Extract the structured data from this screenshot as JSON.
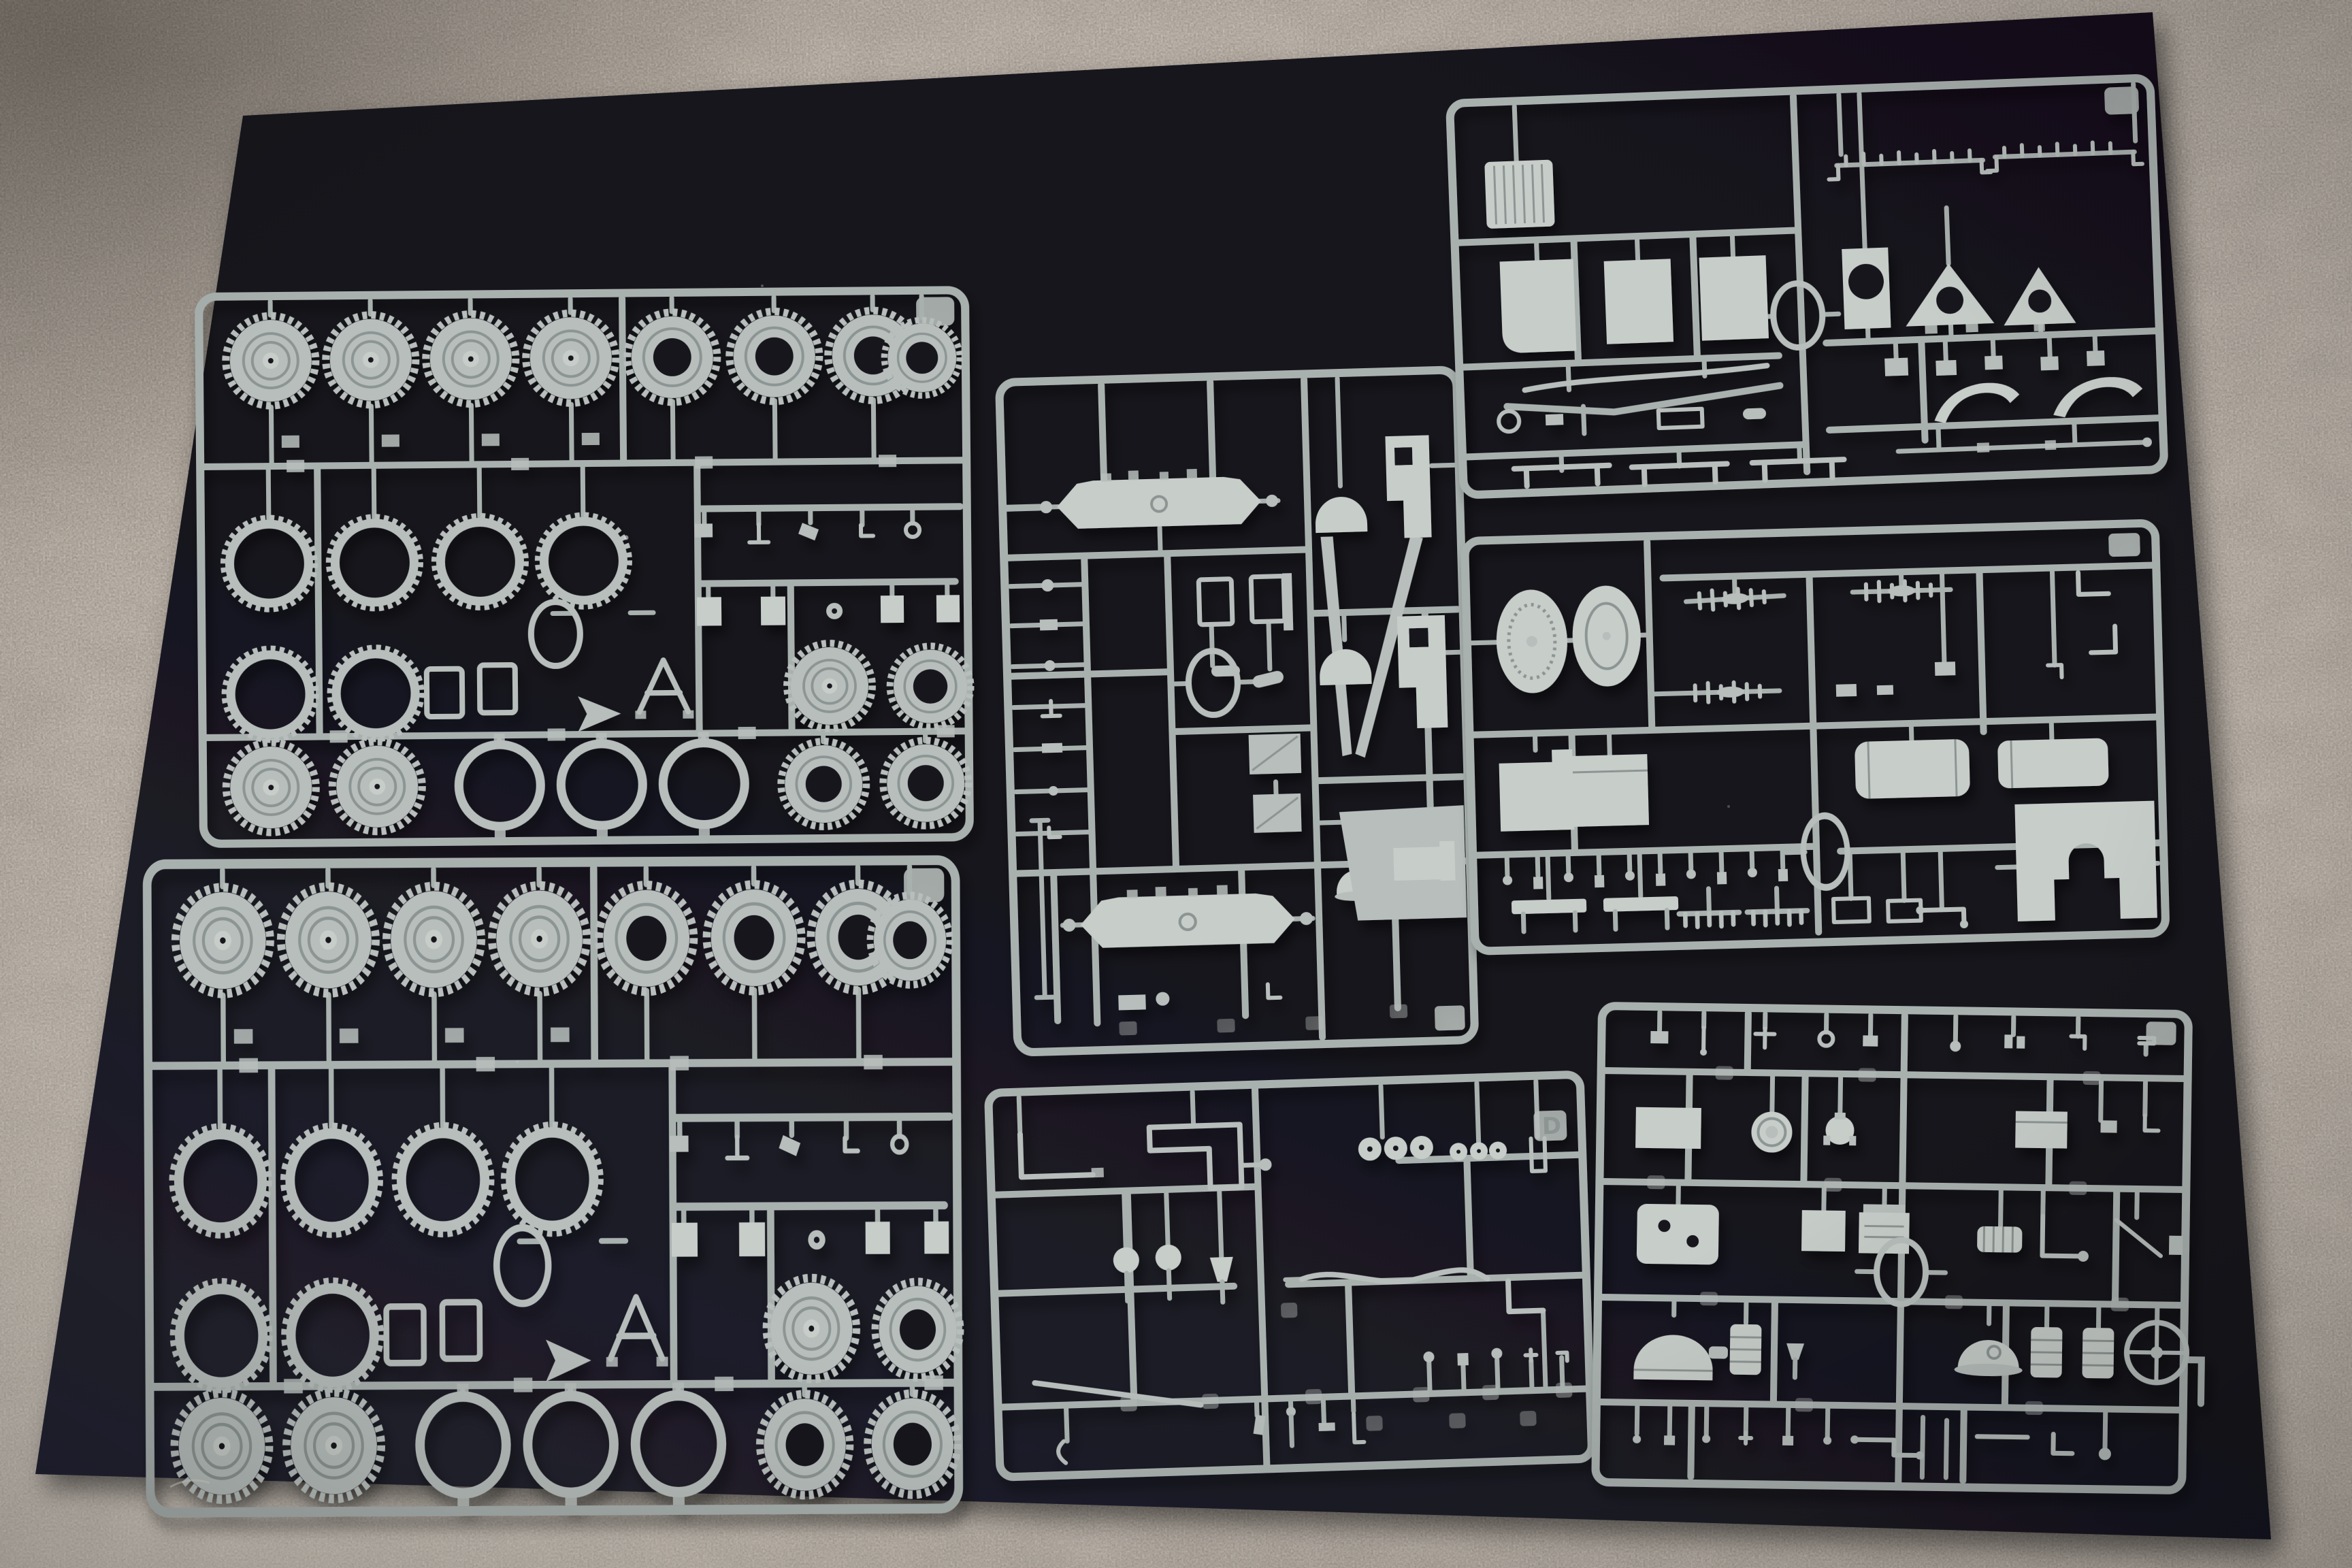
{
  "meta": {
    "title": "Photograph: unbuilt plastic model kit sprues on a dark board",
    "description": "Seven light-gray injection-molded styrene sprues from a military truck model kit, laid out on a dark navy-black mounting board that rests on beige speckled carpet. No packaging or printed text is visible; the only marking is a molded letter tag on one sprue."
  },
  "colors": {
    "carpet-base": "#a89e94",
    "carpet-speck": "#e6dfd4",
    "board-top": "#12111a",
    "board-mid": "#17161e",
    "board-bottom": "#232230",
    "board-hole": "#14131a",
    "plastic": "#a9b1af",
    "plastic-mid": "#b7bebb",
    "plastic-bright": "#c7cdc9",
    "plastic-groove": "#8c9593"
  },
  "sprues": {
    "a1": {
      "name": "wheel sprue, upper left",
      "wheels_with_hubs": 7,
      "open_center_tires": 7,
      "treaded_rings": 6,
      "plain_rings": 3,
      "alignment_oring": 1
    },
    "a2": {
      "name": "wheel sprue, lower left (duplicate of upper left)",
      "wheels_with_hubs": 7,
      "open_center_tires": 7,
      "treaded_rings": 6,
      "plain_rings": 3,
      "alignment_oring": 1
    },
    "b": {
      "name": "chassis sprue, center",
      "axle_assemblies": 2,
      "v_braces": 1,
      "dome_covers": 2,
      "fender_panels": 2,
      "hull_panel": 1,
      "alignment_oring": 1
    },
    "c": {
      "name": "small detail sprue, center bottom",
      "molded_letter": "D",
      "small_discs": 6,
      "levers_and_linkages": "many",
      "alignment_oring": 1
    },
    "d": {
      "name": "body sprue, upper right",
      "radiator_grille": 1,
      "flat_panels": 3,
      "panel_with_round_hole": 1,
      "triangular_gussets": 2,
      "fenders": 2,
      "bumper_bars": 2,
      "alignment_oring": 1
    },
    "e": {
      "name": "tank and seat sprue, middle right",
      "wheel_discs": 2,
      "fuel_tanks": 2,
      "bench_seats": 2,
      "notched_plate": 1,
      "alignment_oring": 1
    },
    "f": {
      "name": "engine and fittings sprue, lower right",
      "engine_block": 1,
      "air_cleaner": 1,
      "canisters": 2,
      "steering_wheel": 1,
      "alignment_oring": 1
    }
  }
}
